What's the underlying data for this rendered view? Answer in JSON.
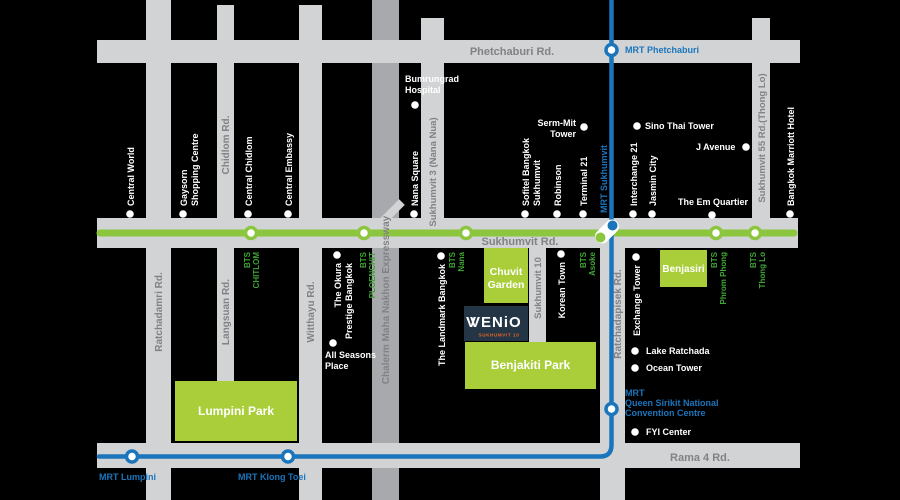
{
  "colors": {
    "bg": "#000000",
    "road": "#D1D3D4",
    "expressway": "#A7A9AC",
    "road_text": "#808285",
    "bts_green": "#8CC63F",
    "bts_text": "#3FA535",
    "park_green": "#A9CE39",
    "mrt_blue": "#1B75BC",
    "venio_navy": "#243645",
    "venio_orange": "#F26522",
    "label_white": "#FFFFFF"
  },
  "roads": {
    "phetchaburi": "Phetchaburi Rd.",
    "sukhumvit": "Sukhumvit Rd.",
    "rama4": "Rama 4 Rd.",
    "ratchadamri": "Ratchadamri Rd.",
    "chidlom": "Chidlom Rd.",
    "langsuan": "Langsuan Rd.",
    "witthayu": "Witthayu Rd.",
    "expressway": "Chalerm Maha Nakhon Expressway",
    "sukhumvit3": "Sukhumvit 3 (Nana Nua)",
    "sukhumvit10": "Sukhumvit 10",
    "ratchadapisek": "Ratchadapisek Rd.",
    "sukhumvit55": "Sukhumvit 55 Rd.(Thong Lo)"
  },
  "transit": {
    "bts_prefix": "BTS",
    "chitlom": "CHITLOM",
    "ploenchit": "PLOENCHIT",
    "nana": "Nana",
    "asoke": "Asoke",
    "phromphong": "Phrom Phong",
    "thonglo": "Thong Lo",
    "mrt_phetchaburi": "MRT Phetchaburi",
    "mrt_sukhumvit": "MRT Sukhumvit",
    "mrt_lumpini": "MRT Lumpini",
    "mrt_klongtoei": "MRT Klong Toei",
    "qsncc_1": "MRT",
    "qsncc_2": "Queen Sirikit National",
    "qsncc_3": "Convention Centre"
  },
  "parks": {
    "lumpini": "Lumpini Park",
    "benjakiti": "Benjakiti Park",
    "chuvit_1": "Chuvit",
    "chuvit_2": "Garden",
    "benjasiri": "Benjasiri"
  },
  "venio": {
    "brand": "VENiO",
    "v_overlay": "V",
    "subtitle": "SUKHUMVIT 10"
  },
  "landmarks": {
    "central_world": "Central World",
    "gaysorn_1": "Gaysorn",
    "gaysorn_2": "Shopping Centre",
    "central_chidlom": "Central Chidlom",
    "central_embassy": "Central Embassy",
    "bumrungrad_1": "Bumrungrad",
    "bumrungrad_2": "Hospital",
    "nana_square": "Nana Square",
    "sermmit_1": "Serm-Mit",
    "sermmit_2": "Tower",
    "sofitel_1": "Sofitel Bangkok",
    "sofitel_2": "Sukhumvit",
    "robinson": "Robinson",
    "terminal21": "Terminal 21",
    "sino_thai": "Sino Thai Tower",
    "j_avenue": "J Avenue",
    "interchange21": "Interchange 21",
    "jasmin_city": "Jasmin City",
    "em_quartier": "The Em Quartier",
    "marriott": "Bangkok Marriott Hotel",
    "okura_1": "The Okura",
    "okura_2": "Prestige Bangkok",
    "all_seasons_1": "All Seasons",
    "all_seasons_2": "Place",
    "landmark_bkk": "The Landmark Bangkok",
    "korean_town": "Korean Town",
    "exchange_tower": "Exchange Tower",
    "lake_ratchada": "Lake Ratchada",
    "ocean_tower": "Ocean Tower",
    "fyi": "FYI Center"
  }
}
